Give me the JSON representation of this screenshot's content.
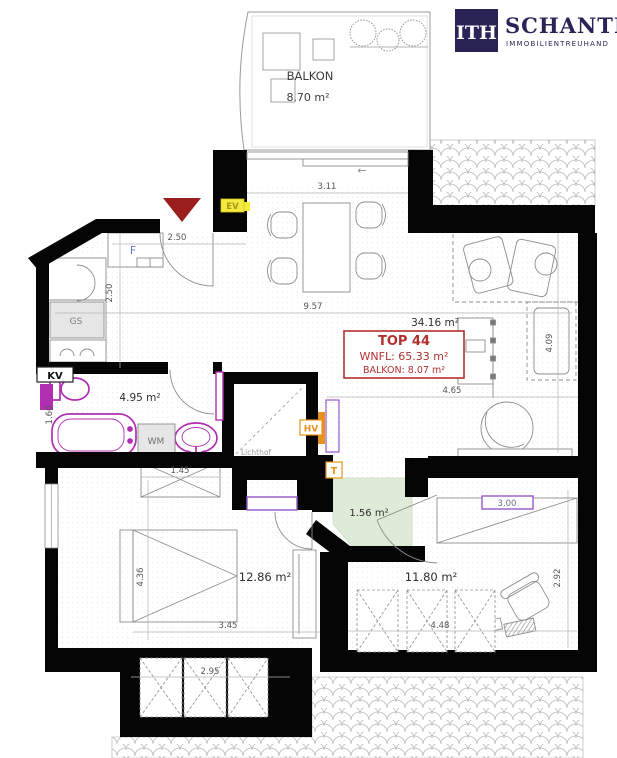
{
  "logo": {
    "monogram": "ITH",
    "company": "SCHANTL",
    "tagline": "IMMOBILIENTREUHAND"
  },
  "unit_box": {
    "title": "TOP 44",
    "living_area": "WNFL: 65.33 m²",
    "balcony_area": "BALKON: 8.07 m²"
  },
  "rooms": {
    "balcony": {
      "name": "BALKON",
      "area": "8.70 m²"
    },
    "living": {
      "area": "34.16 m²"
    },
    "bathroom": {
      "area": "4.95 m²"
    },
    "hallway": {
      "area": "1.56 m²"
    },
    "bedroom1": {
      "area": "12.86 m²"
    },
    "bedroom2": {
      "area": "11.80 m²"
    },
    "lightwell": {
      "name": "Lichthof"
    }
  },
  "fixture_labels": {
    "f": "F",
    "gs": "GS",
    "kv": "KV",
    "wm": "WM",
    "ev": "EV",
    "hv": "HV",
    "t": "T"
  },
  "dimensions": {
    "balcony_door": "3.11",
    "living_width": "9.57",
    "kitchen_depth": "2.50",
    "entry": "2.50",
    "living_right_width": "4.65",
    "living_right_depth": "4.09",
    "bath_segment": "1.45",
    "bath_depth": "1.60",
    "bedroom1_depth": "4.36",
    "bedroom1_width": "3.45",
    "bedroom1_dormer": "2.95",
    "bedroom2_width": "4.48",
    "bedroom2_depth": "2.92",
    "bedroom2_window": "3.00"
  },
  "symbols": {
    "slide_arrow": "←"
  },
  "colors": {
    "wall": "#050505",
    "sanitary_magenta": "#b02fb0",
    "window_purple": "#9757c8",
    "entrance_red": "#9b1e1e",
    "unit_box_red": "#b23030",
    "energy_yellow": "#f4ea3d",
    "heating_orange": "#e8921a",
    "hallway_green": "#deebd7",
    "logo_navy": "#2a2456",
    "label_blue": "#6379cf"
  }
}
